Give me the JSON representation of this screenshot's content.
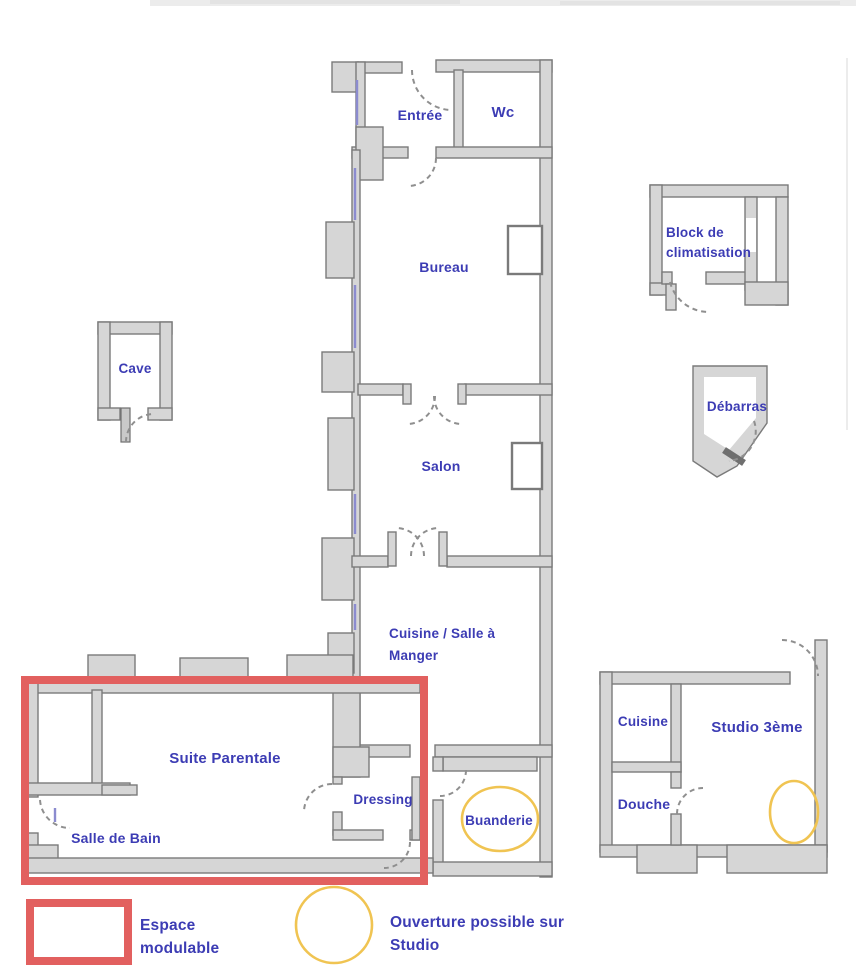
{
  "colors": {
    "label_text": "#3c3cb4",
    "wall_fill": "#d6d6d6",
    "wall_stroke": "#7a7a7a",
    "modulable_outline": "#e2605f",
    "opening_outline": "#f0c452"
  },
  "rooms": {
    "entree": "Entrée",
    "wc": "Wc",
    "bureau": "Bureau",
    "salon": "Salon",
    "cuisine_line1": "Cuisine / Salle à",
    "cuisine_line2": "Manger",
    "suite_parentale": "Suite Parentale",
    "salle_de_bain": "Salle de Bain",
    "dressing": "Dressing",
    "buanderie": "Buanderie",
    "cave": "Cave",
    "block_clim_line1": "Block de",
    "block_clim_line2": "climatisation",
    "debarras": "Débarras",
    "studio_cuisine": "Cuisine",
    "studio": "Studio 3ème",
    "douche": "Douche"
  },
  "legend": {
    "espace_line1": "Espace",
    "espace_line2": "modulable",
    "ouverture_line1": "Ouverture possible sur",
    "ouverture_line2": "Studio"
  }
}
